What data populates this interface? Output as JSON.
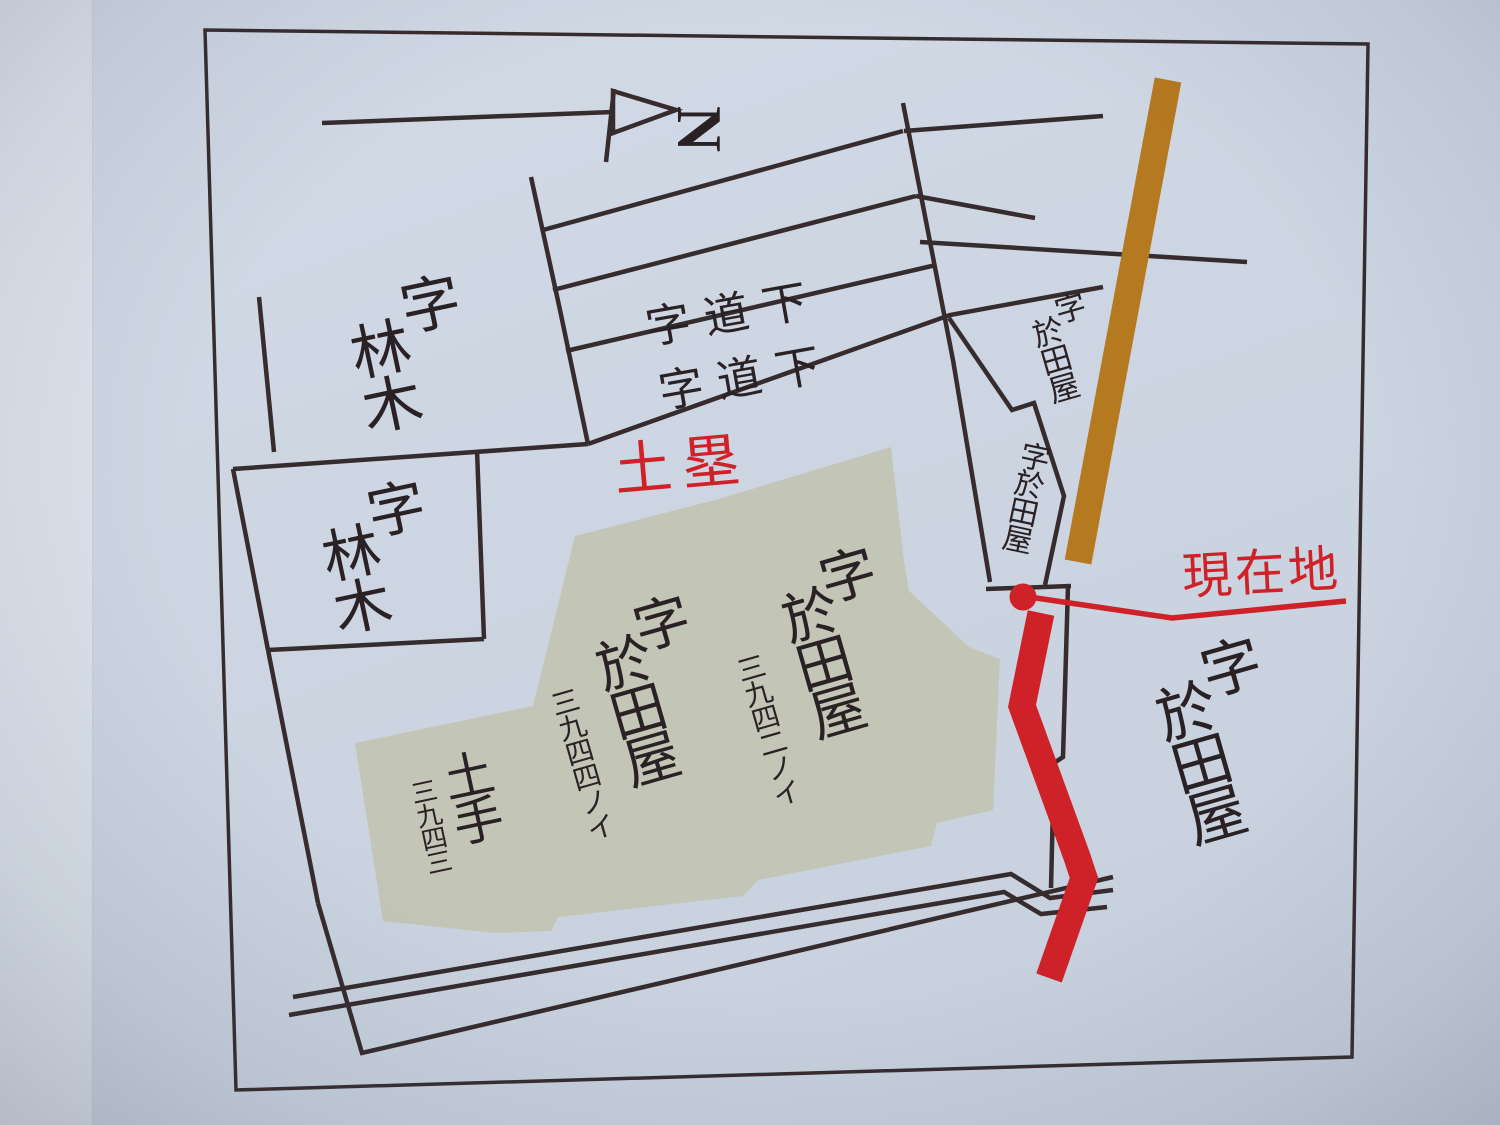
{
  "map": {
    "type_note": "hand-drawn parcel map on signboard",
    "north": {
      "letter": "N"
    },
    "areas": {
      "hayashiki1": {
        "first": "字",
        "rest": "林木"
      },
      "hayashiki2": {
        "first": "字",
        "rest": "林木"
      },
      "michishita1": {
        "text": "字道下"
      },
      "michishita2": {
        "text": "字道下"
      },
      "dorui": {
        "text": "土塁"
      },
      "otaya_3942": {
        "first": "字",
        "rest": "於田屋",
        "number": "三九四二ノイ"
      },
      "otaya_3944": {
        "first": "字",
        "rest": "於田屋",
        "number": "三九四四ノイ"
      },
      "dote": {
        "text": "土手",
        "number": "三九四三"
      },
      "otaya_topright": {
        "first": "字",
        "rest": "於田屋"
      },
      "otaya_mid": {
        "text": "字於田屋"
      },
      "otaya_right": {
        "first": "字",
        "rest": "於田屋"
      },
      "genzaichi": {
        "text": "現在地"
      }
    },
    "colors": {
      "red": "#cf2128",
      "brown": "#b5791f",
      "line": "#362b2d",
      "parcel_fill": "#c3c5b6",
      "background": "#ccd5e1"
    }
  }
}
